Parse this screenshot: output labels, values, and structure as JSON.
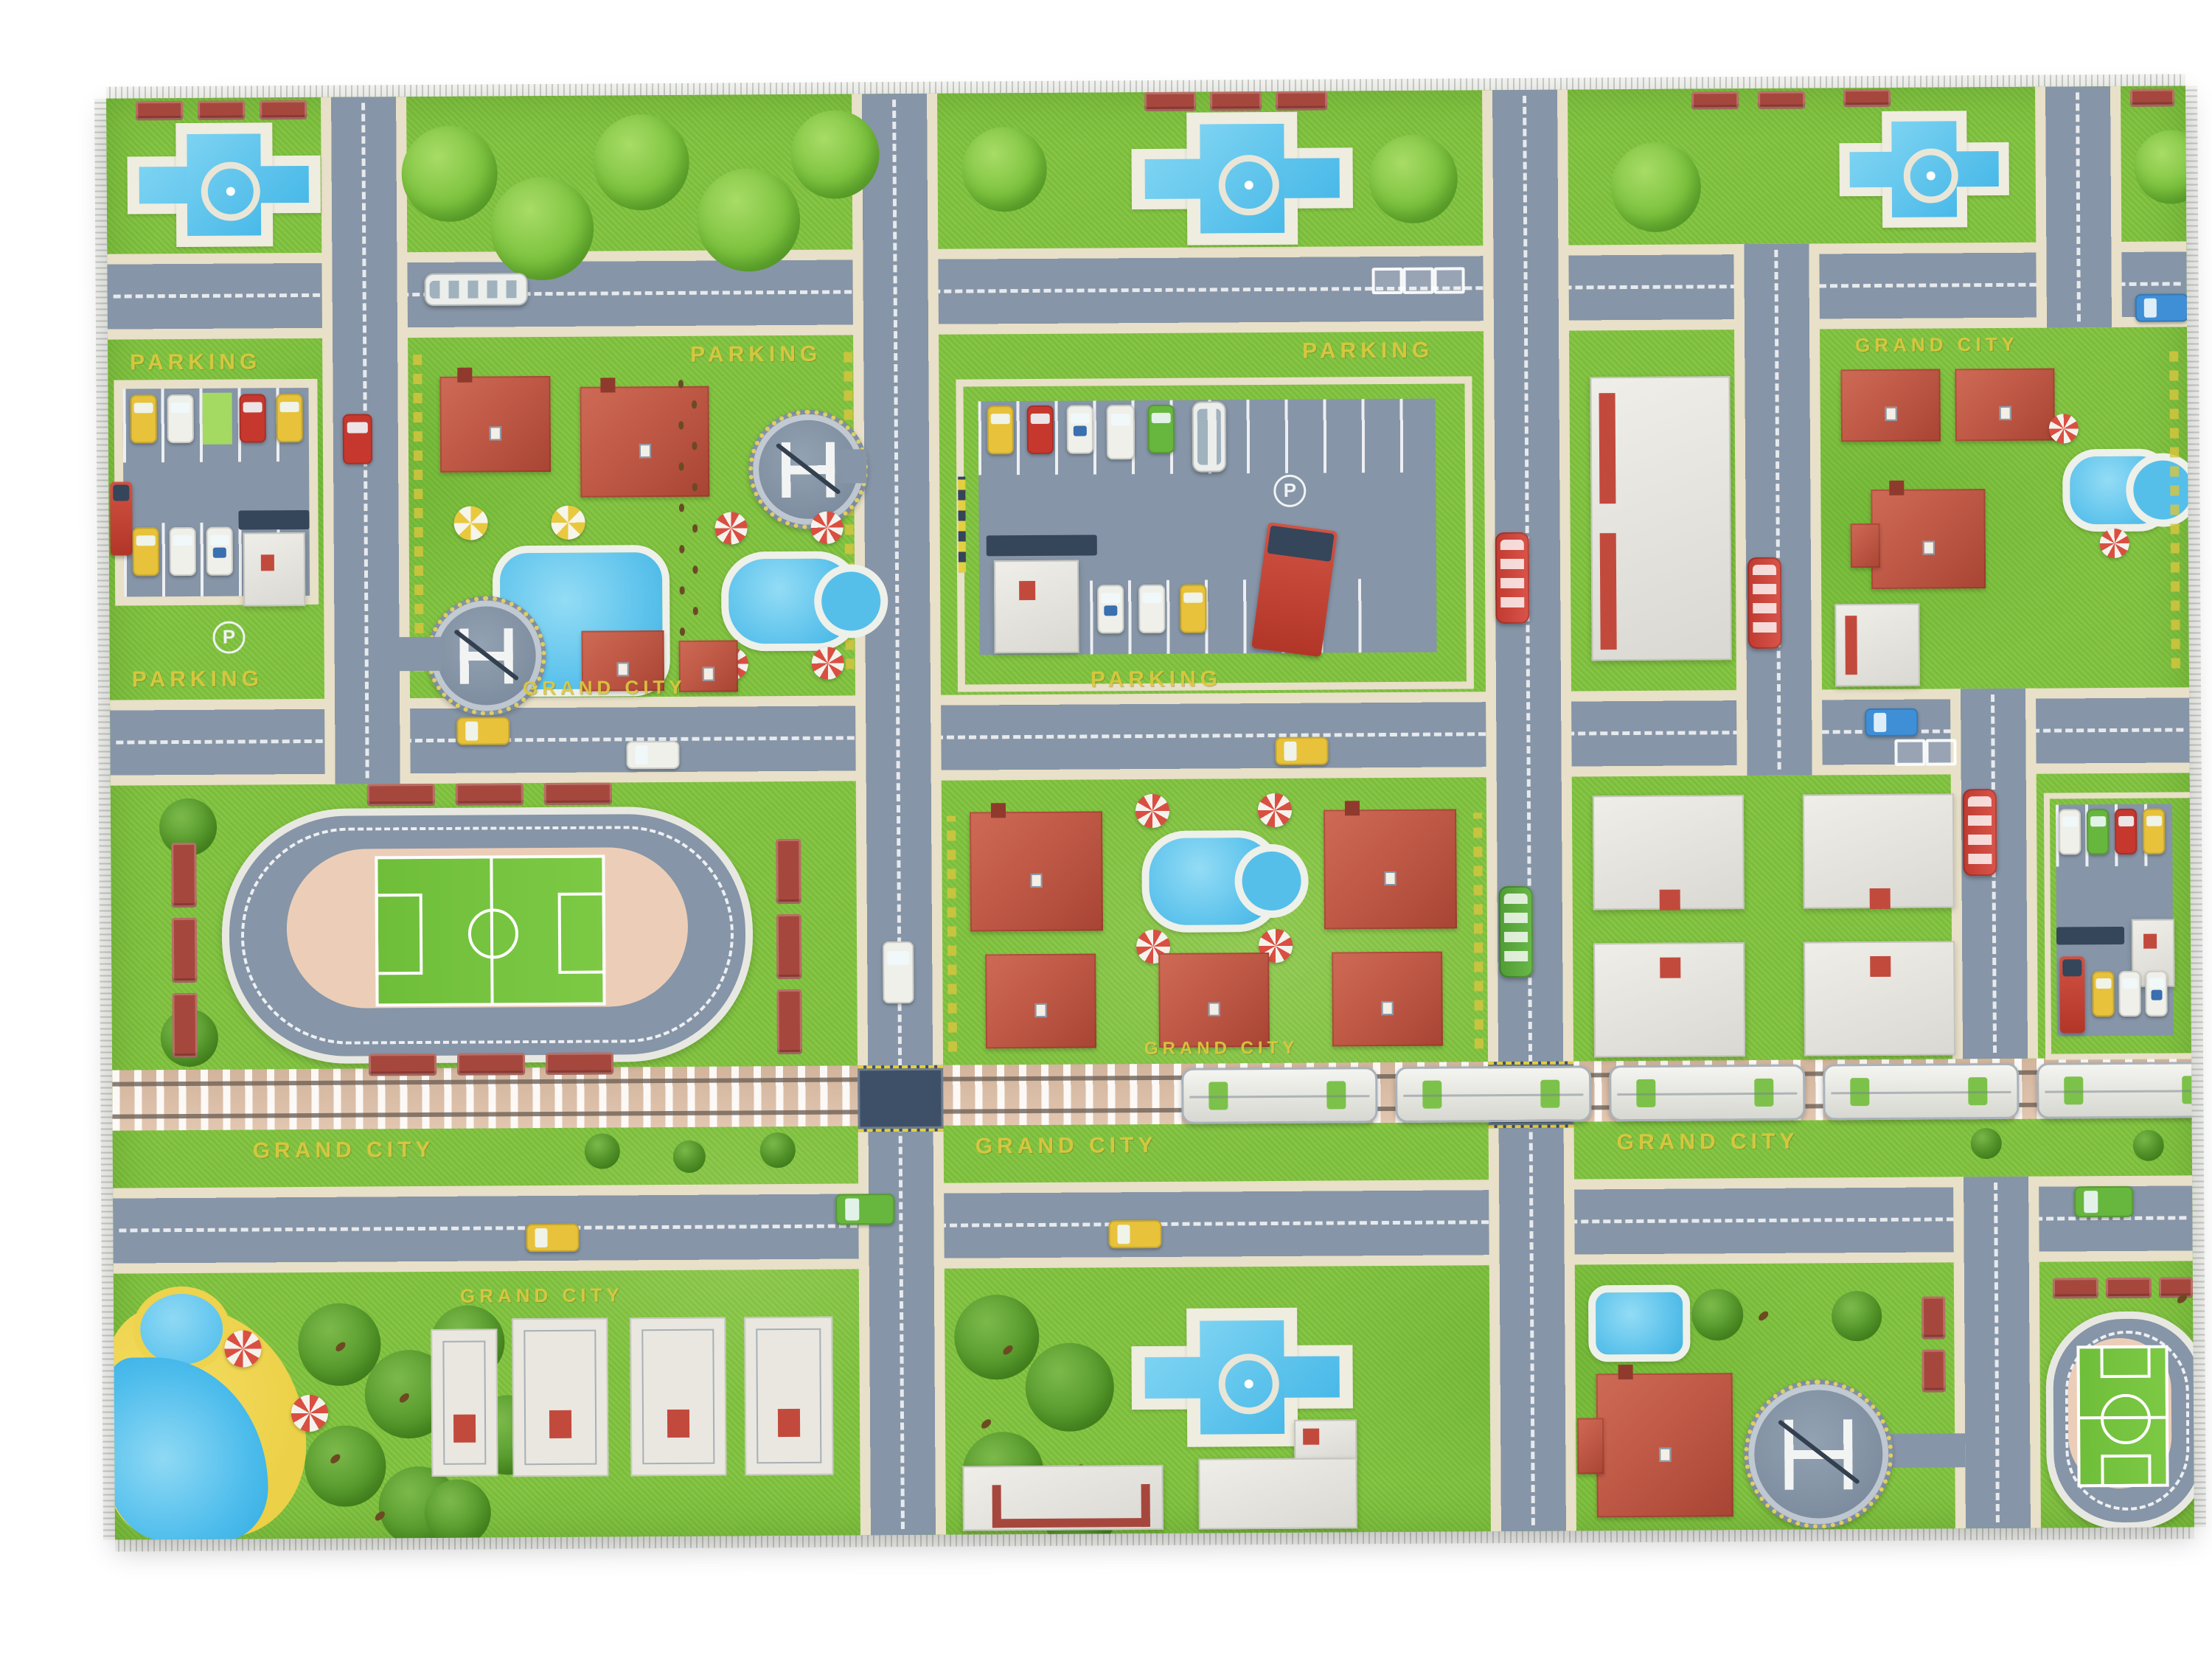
{
  "scene": {
    "subject": "children's city road-map play rug photographed on a white background",
    "style": "top-view toy town with roads, railway, parks and buildings"
  },
  "texts": {
    "grand_city": "GRAND CITY",
    "parking": "PARKING",
    "parking_sign": "P"
  },
  "palette": {
    "grass": "#7fc23d",
    "grass_dark": "#5a9e2c",
    "road_gray": "#8695a7",
    "sidewalk_tan": "#e8e0c8",
    "marking_white": "#eef1f2",
    "roof_red": "#bc5a49",
    "water_blue": "#5ec3ec",
    "sand_yellow": "#eed34e",
    "building_white": "#e9e7e1",
    "accent_red": "#c24a3d",
    "rail_bed_tan": "#dcc0aa",
    "crossing_navy": "#3e5068",
    "hedge_text_yellow": "#dcc83f",
    "bench_red": "#a6473d",
    "pitch_green": "#6fbe3a",
    "infield_tan": "#ecceb8"
  },
  "inventory": {
    "fountain_plazas": 4,
    "helipads": 3,
    "stadiums": 2,
    "swimming_pools": 5,
    "pond": 1,
    "red_roof_houses": 13,
    "white_buildings": 10,
    "house_plots": 4,
    "parking_lots": 3,
    "gas_stations": 2,
    "train_cars": 5,
    "railroad_crossings": 2,
    "beach_corner": 1,
    "park_benches": 29,
    "parasols": 14,
    "trees": 34,
    "birds": 10,
    "vehicles": {
      "taxi_yellow": 11,
      "police_car": 4,
      "white_car_van": 8,
      "red_car": 4,
      "green_car": 4,
      "blue_car": 2,
      "bus_red": 3,
      "bus_green": 1,
      "bus_white": 2,
      "truck_red": 3
    }
  }
}
